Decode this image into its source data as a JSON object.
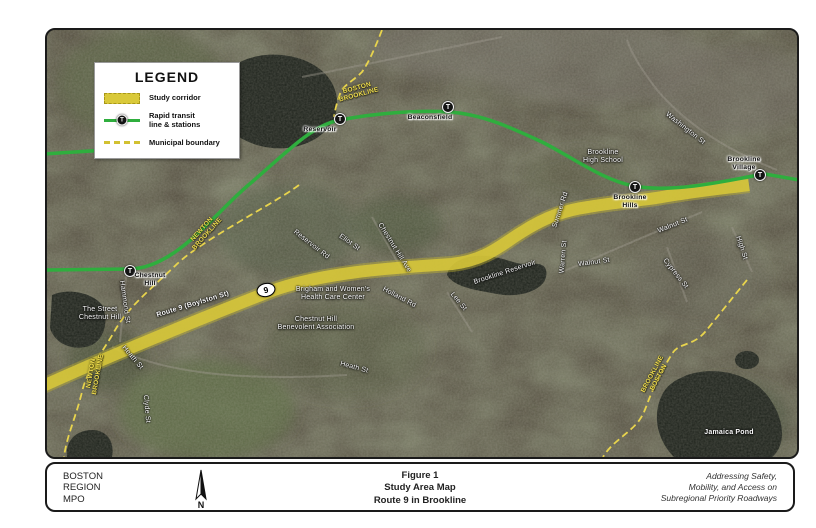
{
  "colors": {
    "corridor_yellow": "#d9c93a",
    "transit_green": "#2fae3e",
    "boundary_yellow": "#e8d44d",
    "water_dark": "#1d221b"
  },
  "legend": {
    "title": "LEGEND",
    "items": [
      {
        "label": "Study corridor",
        "type": "corridor"
      },
      {
        "label": "Rapid transit\nline & stations",
        "type": "transit"
      },
      {
        "label": "Municipal boundary",
        "type": "boundary"
      }
    ]
  },
  "map": {
    "shield": {
      "text": "9",
      "x": 219,
      "y": 260
    },
    "stations": [
      {
        "name": "Chestnut Hill",
        "x": 83,
        "y": 241,
        "lines": [
          "Chestnut",
          "Hill"
        ],
        "label_x": 103,
        "label_y": 250
      },
      {
        "name": "Reservoir",
        "x": 293,
        "y": 89,
        "lines": [
          "Reservoir"
        ],
        "label_x": 273,
        "label_y": 100
      },
      {
        "name": "Beaconsfield",
        "x": 401,
        "y": 77,
        "lines": [
          "Beaconsfield"
        ],
        "label_x": 383,
        "label_y": 88
      },
      {
        "name": "Brookline Hills",
        "x": 588,
        "y": 157,
        "lines": [
          "Brookline",
          "Hills"
        ],
        "label_x": 583,
        "label_y": 172
      },
      {
        "name": "Brookline Village",
        "x": 713,
        "y": 145,
        "lines": [
          "Brookline",
          "Village"
        ],
        "label_x": 697,
        "label_y": 134
      }
    ],
    "labels": [
      {
        "text": "Washington St",
        "x": 638,
        "y": 99,
        "rot": 38,
        "color": "white"
      },
      {
        "lines": [
          "Brookline",
          "High School"
        ],
        "x": 556,
        "y": 127,
        "rot": 0,
        "color": "white"
      },
      {
        "text": "Sumner Rd",
        "x": 514,
        "y": 180,
        "rot": -72,
        "color": "white"
      },
      {
        "text": "Warren St",
        "x": 517,
        "y": 227,
        "rot": -85,
        "color": "white"
      },
      {
        "text": "Walnut St",
        "x": 547,
        "y": 233,
        "rot": -8,
        "color": "white"
      },
      {
        "text": "Walnut St",
        "x": 626,
        "y": 196,
        "rot": -22,
        "color": "white"
      },
      {
        "text": "Cypress St",
        "x": 628,
        "y": 244,
        "rot": 52,
        "color": "white"
      },
      {
        "text": "High St",
        "x": 694,
        "y": 218,
        "rot": 72,
        "color": "white"
      },
      {
        "text": "Lee St",
        "x": 411,
        "y": 272,
        "rot": 50,
        "color": "white"
      },
      {
        "text": "Brookline Reservoir",
        "x": 458,
        "y": 243,
        "rot": -18,
        "color": "white"
      },
      {
        "text": "Holland Rd",
        "x": 352,
        "y": 268,
        "rot": 28,
        "color": "white"
      },
      {
        "text": "Reservoir Rd",
        "x": 264,
        "y": 215,
        "rot": 38,
        "color": "white"
      },
      {
        "text": "Eliot St",
        "x": 302,
        "y": 213,
        "rot": 35,
        "color": "white"
      },
      {
        "text": "Chestnut Hill Ave",
        "x": 347,
        "y": 218,
        "rot": 58,
        "color": "white"
      },
      {
        "lines": [
          "Brigham and Women's",
          "Health Care Center"
        ],
        "x": 286,
        "y": 264,
        "rot": 0,
        "color": "white"
      },
      {
        "lines": [
          "Chestnut Hill",
          "Benevolent Association"
        ],
        "x": 269,
        "y": 294,
        "rot": 0,
        "color": "white"
      },
      {
        "text": "Route 9 (Boylston St)",
        "x": 146,
        "y": 275,
        "rot": -17,
        "color": "white",
        "bold": true
      },
      {
        "text": "Hammond St",
        "x": 77,
        "y": 272,
        "rot": 82,
        "color": "white"
      },
      {
        "text": "Heath St",
        "x": 85,
        "y": 328,
        "rot": 50,
        "color": "white"
      },
      {
        "text": "Heath St",
        "x": 307,
        "y": 338,
        "rot": 15,
        "color": "white"
      },
      {
        "text": "Clyde St",
        "x": 99,
        "y": 379,
        "rot": 85,
        "color": "white"
      },
      {
        "lines": [
          "The Street",
          "Chestnut Hill"
        ],
        "x": 53,
        "y": 284,
        "rot": 0,
        "color": "white"
      },
      {
        "text": "Jamaica Pond",
        "x": 682,
        "y": 403,
        "rot": 0,
        "color": "white",
        "bold": true
      },
      {
        "lines": [
          "BOSTON",
          "BROOKLINE"
        ],
        "x": 311,
        "y": 62,
        "rot": -15,
        "color": "yellow"
      },
      {
        "lines": [
          "NEWTON",
          "BROOKLINE"
        ],
        "x": 158,
        "y": 202,
        "rot": -48,
        "color": "yellow"
      },
      {
        "lines": [
          "NEWTON",
          "BROOKLINE"
        ],
        "x": 48,
        "y": 344,
        "rot": -80,
        "color": "yellow"
      },
      {
        "lines": [
          "BROOKLINE",
          "BOSTON"
        ],
        "x": 609,
        "y": 346,
        "rot": -62,
        "color": "yellow"
      }
    ]
  },
  "footer": {
    "org_lines": "BOSTON\nREGION\nMPO",
    "title_lines": "Figure 1\nStudy Area Map\nRoute 9 in Brookline",
    "tagline_lines": "Addressing Safety,\nMobility, and Access on\nSubregional Priority Roadways",
    "north_label": "N"
  }
}
